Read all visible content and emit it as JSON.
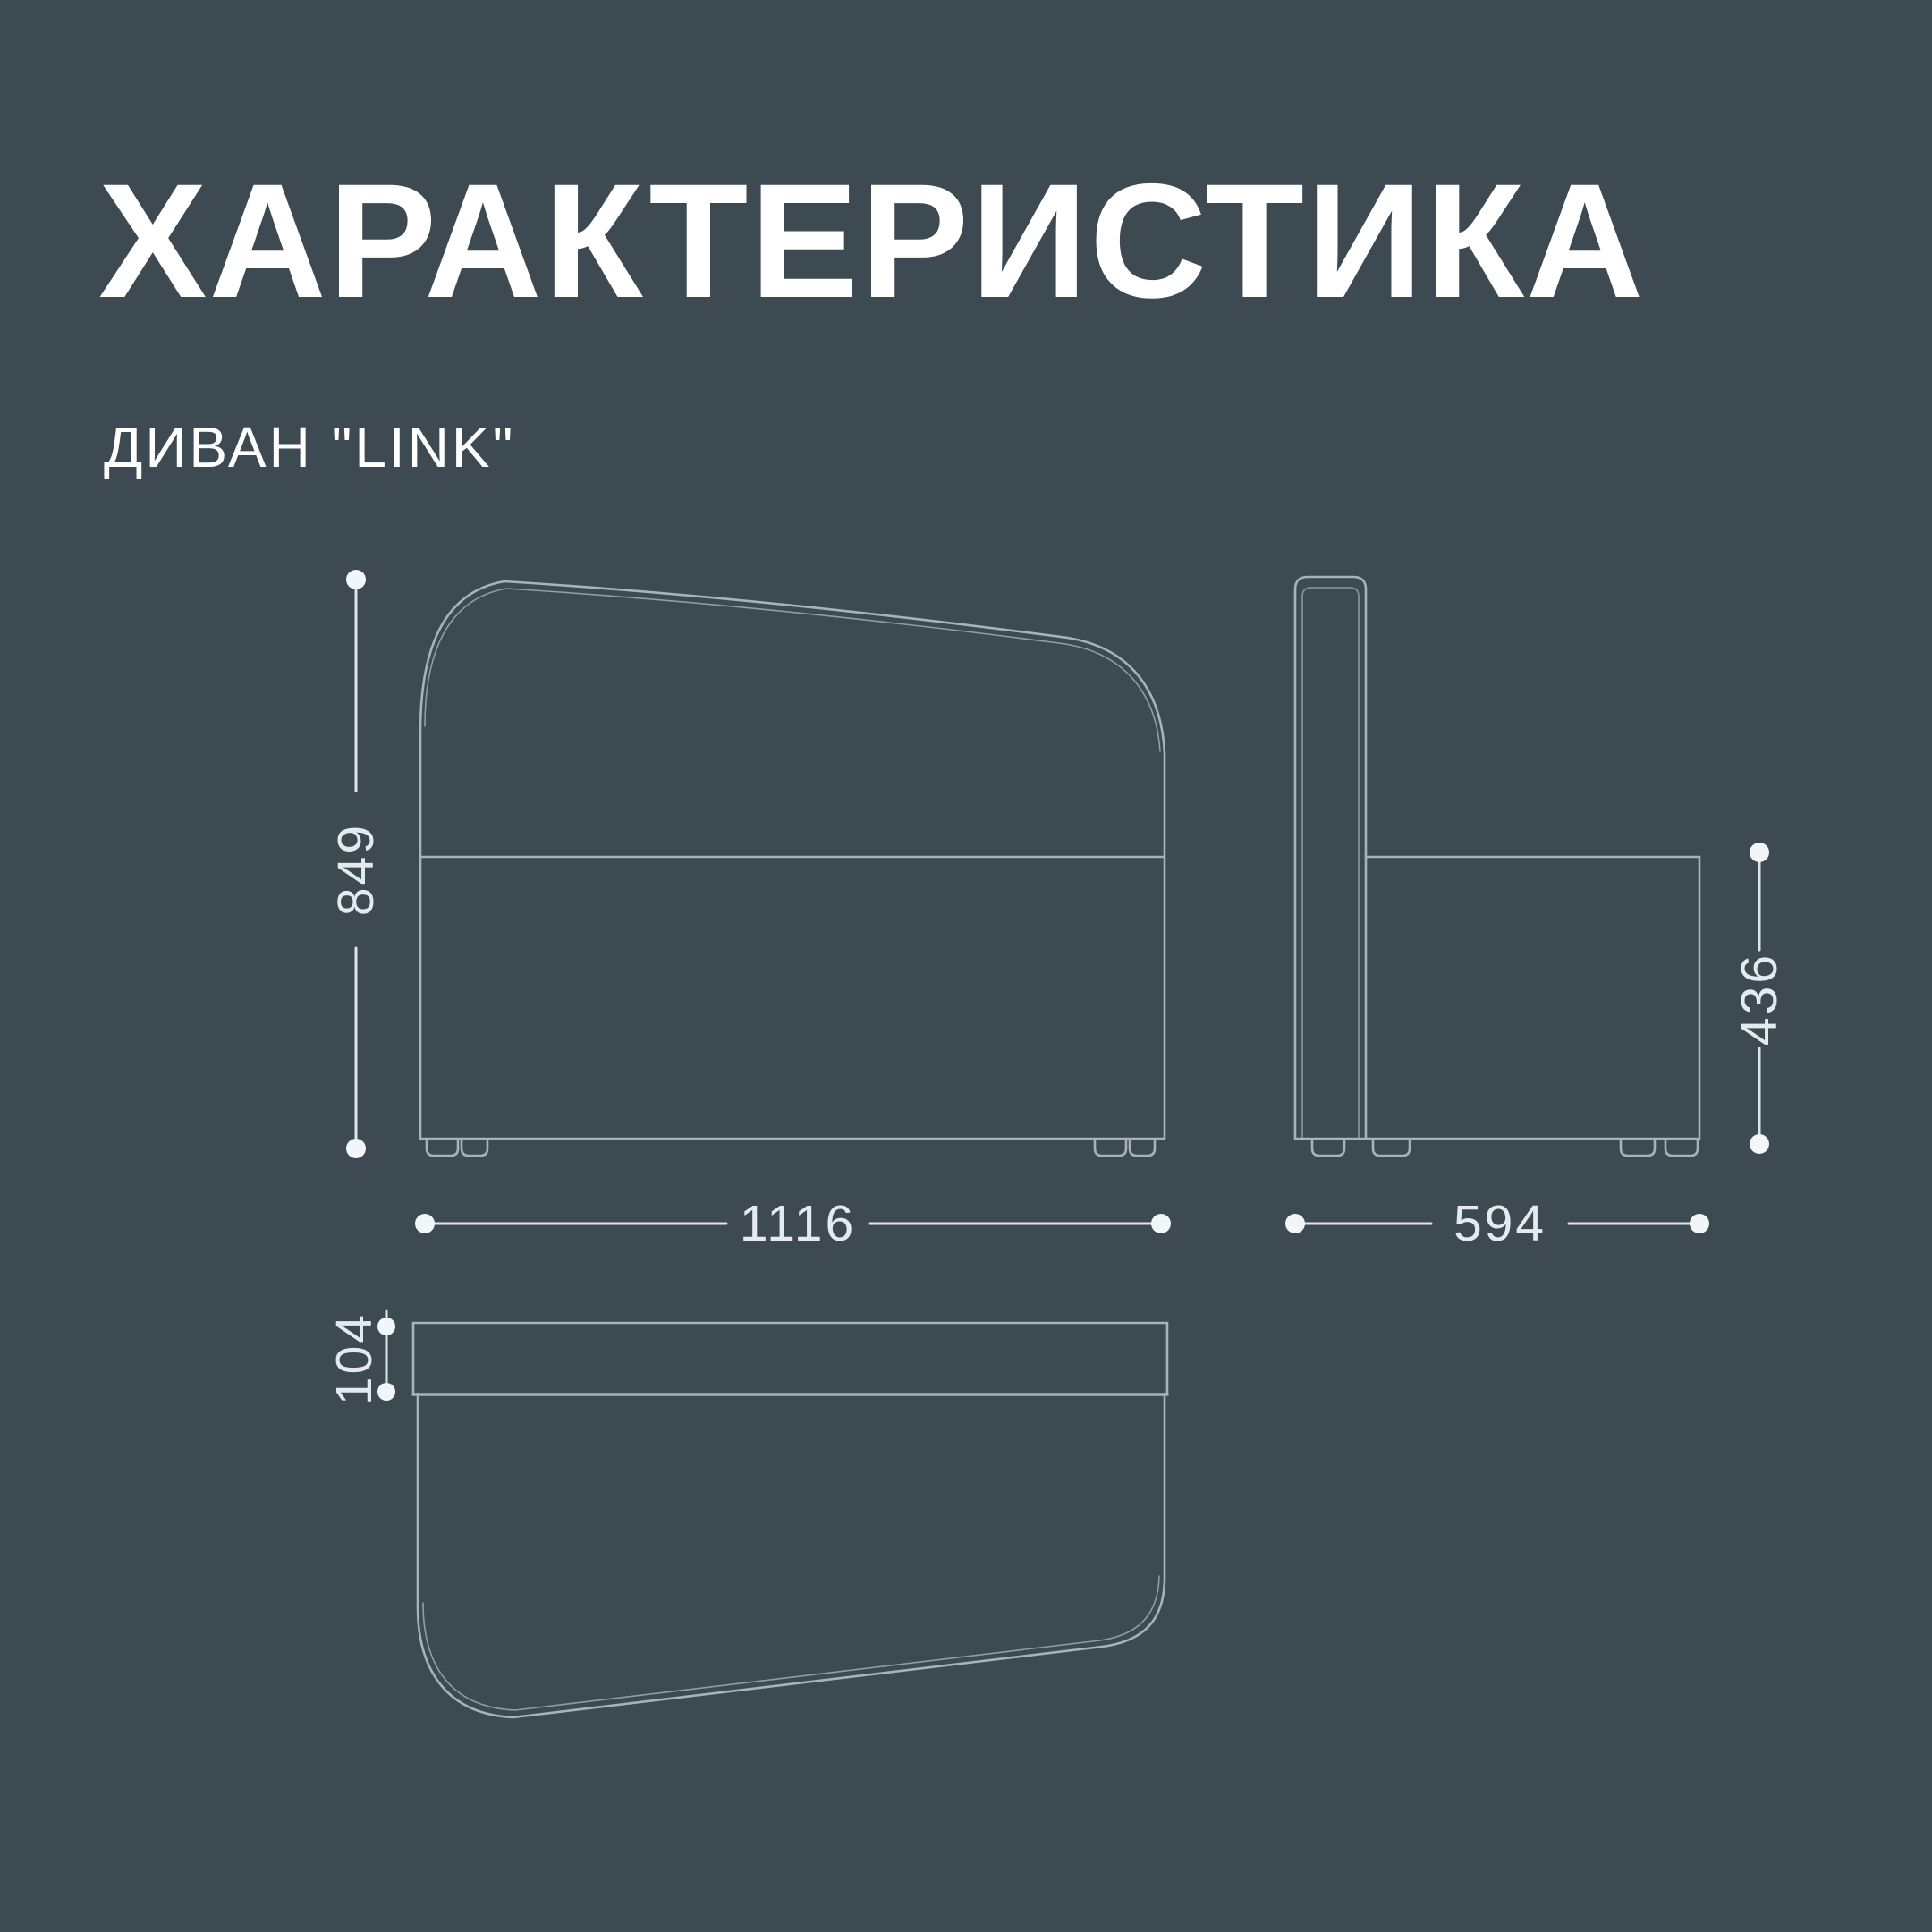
{
  "header": {
    "title": "ХАРАКТЕРИСТИКА",
    "subtitle": "ДИВАН \"LINK\""
  },
  "dimensions": {
    "overall_height": "849",
    "overall_width": "1116",
    "seat_height": "436",
    "overall_depth": "594",
    "backrest_top_depth": "104"
  },
  "colors": {
    "background": "#3E4A52",
    "outline_line": "#A7B2B9",
    "dimension_line": "#E4EAEE",
    "text": "#FFFFFF"
  }
}
